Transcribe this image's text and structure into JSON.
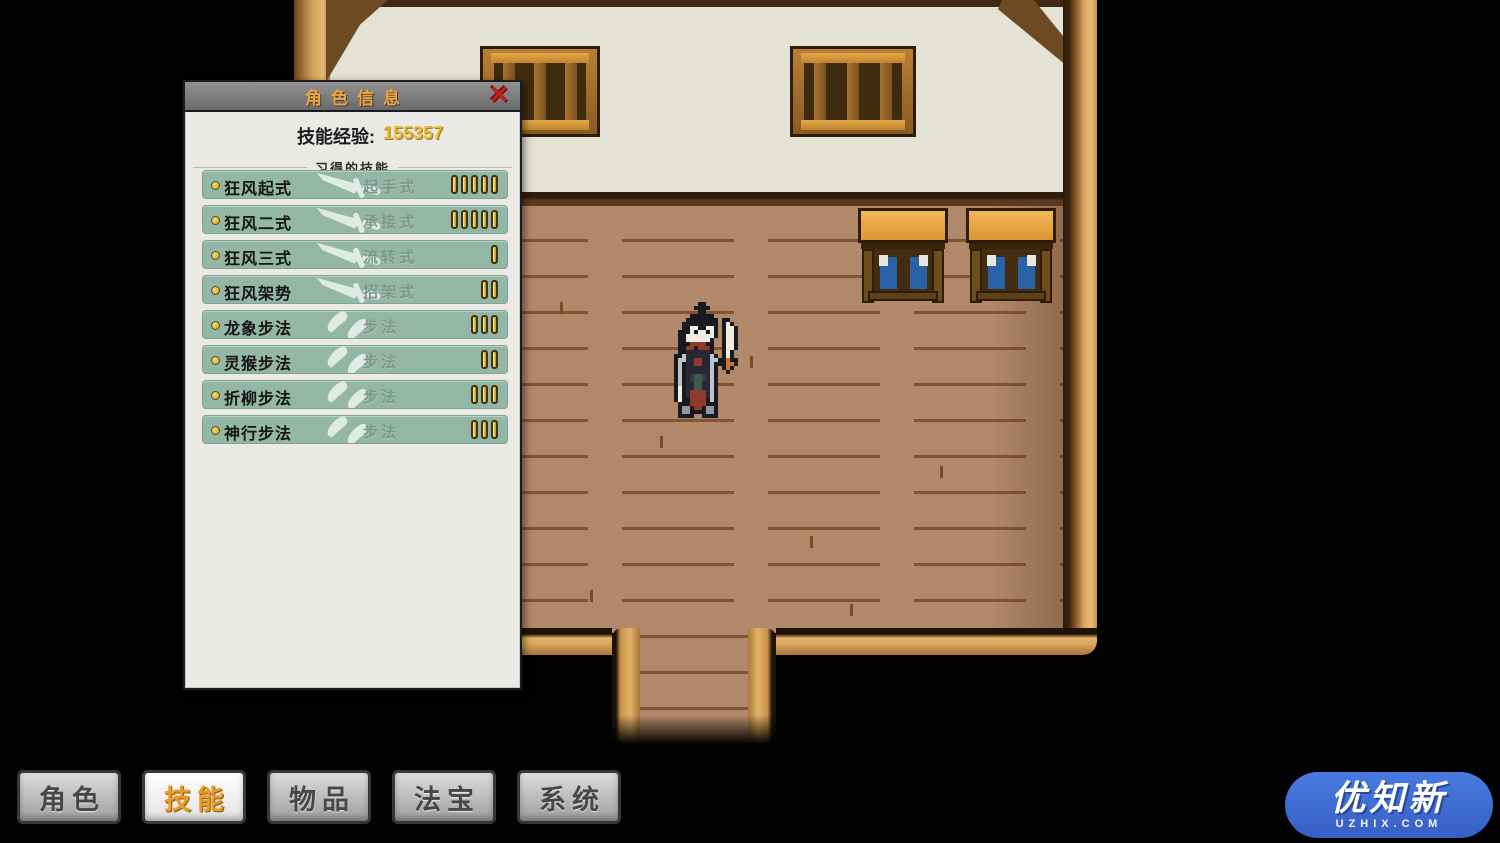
{
  "panel": {
    "title": "角色信息",
    "close_label": "✕",
    "exp_label": "技能经验:",
    "exp_value": "155357",
    "section_title": "习得的技能",
    "skills": [
      {
        "name": "狂风起式",
        "type": "起手式",
        "icon": "sword-icon",
        "level": 5
      },
      {
        "name": "狂风二式",
        "type": "承接式",
        "icon": "sword-icon",
        "level": 5
      },
      {
        "name": "狂风三式",
        "type": "流转式",
        "icon": "sword-icon",
        "level": 1
      },
      {
        "name": "狂风架势",
        "type": "招架式",
        "icon": "sword-icon",
        "level": 2
      },
      {
        "name": "龙象步法",
        "type": "步法",
        "icon": "steps-icon",
        "level": 3
      },
      {
        "name": "灵猴步法",
        "type": "步法",
        "icon": "steps-icon",
        "level": 2
      },
      {
        "name": "折柳步法",
        "type": "步法",
        "icon": "steps-icon",
        "level": 3
      },
      {
        "name": "神行步法",
        "type": "步法",
        "icon": "steps-icon",
        "level": 3
      }
    ]
  },
  "menu": {
    "buttons": [
      {
        "label": "角色",
        "active": false
      },
      {
        "label": "技能",
        "active": true
      },
      {
        "label": "物品",
        "active": false
      },
      {
        "label": "法宝",
        "active": false
      },
      {
        "label": "系统",
        "active": false
      }
    ]
  },
  "watermark": {
    "title": "优知新",
    "subtitle": "UZHIX.COM",
    "color": "#3f6fd1"
  },
  "colors": {
    "panel_title": "#f2a33c",
    "exp_value": "#e8b93c",
    "skill_row_bg": "#93b6a6",
    "level_bar_gold": "#e3bb3f",
    "active_button_text": "#e89b28",
    "close_red": "#c21f1f",
    "floor_brown": "#b1886a",
    "wall_white": "#e4e1d5"
  },
  "character_sprite": {
    "pixel_size": 4,
    "palette": {
      "K": "#191920",
      "W": "#f1ece1",
      "N": "#262833",
      "G": "#bfc3c9",
      "R": "#8f3b2b",
      "O": "#d2712c",
      "T": "#3c5a4c",
      "S": "#9298a0",
      "D": "#343845"
    },
    "rows": [
      "......KK........",
      ".....KKKK.......",
      "......KK........",
      "....KKKKKK......",
      "...KKKKKKKK.KK..",
      "..KKKKKKKKK.KWK.",
      "..KKWWKKWWK.KWWK",
      ".KKKWKWWKWK.KWWK",
      ".KKWWWWWWWK.KWWK",
      ".KKWWWWWWK..KWWK",
      ".KKKRRRRKK..KWWK",
      ".KKRRKRRRK..KWWK",
      ".KKNNNNNNK..KWK.",
      "KKGNNNNNNGK.KWK.",
      "KGGNNRRNNGGKKOKK",
      "KGKNNRRNNGKKKOOK",
      "KGKNNNNNNGK.KOK.",
      "KGKNNNNNNGK..K..",
      "KGKNDTTDNGK.....",
      "KGKNDTTDNGK.....",
      "KGKNNTTNNGK.....",
      "KWKNNTTNNGK.....",
      "KWKNRRRRNGK.....",
      "KWKNRRRRNGK.....",
      "KWKKRRRRKGK.....",
      ".KKKRRRRKKK.....",
      ".KSSKRRKSSK.....",
      ".KSSKKKKSSK.....",
      ".KKKK..KKKK....."
    ]
  }
}
